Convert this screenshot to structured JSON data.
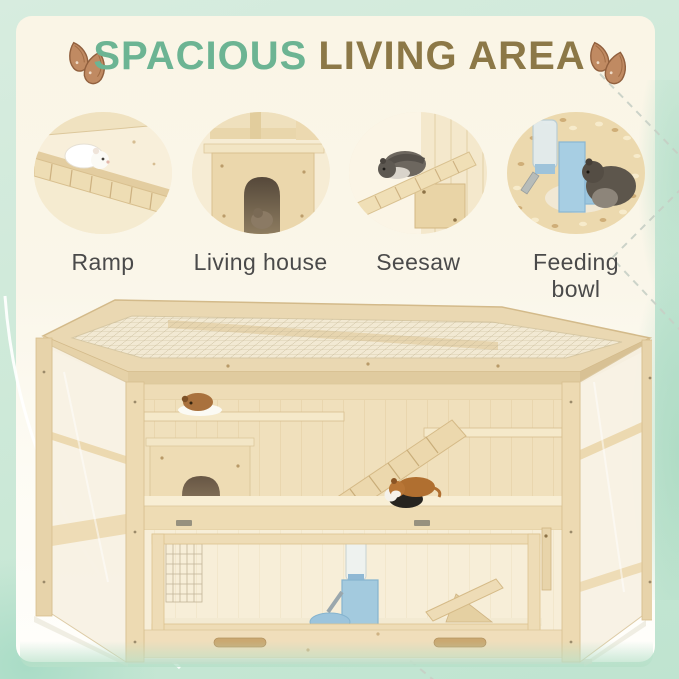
{
  "header": {
    "title_part1": "SPACIOUS",
    "title_part2": "LIVING AREA"
  },
  "features": [
    {
      "label": "Ramp"
    },
    {
      "label": "Living house"
    },
    {
      "label": "Seesaw"
    },
    {
      "label": "Feeding bowl"
    }
  ],
  "icons": {
    "left": "almond-seeds-icon",
    "right": "almond-seeds-icon"
  },
  "colors": {
    "title_teal": "#6cb493",
    "title_brown": "#8c7847",
    "label_gray": "#4a4a4a",
    "mint_border": "#c7e6d4",
    "panel_cream": "#faf5e6",
    "wood_light": "#f3e6c4",
    "wood_mid": "#ecd9b2",
    "wood_dark": "#d3ba8a",
    "feeder_blue": "#a5cce2"
  }
}
